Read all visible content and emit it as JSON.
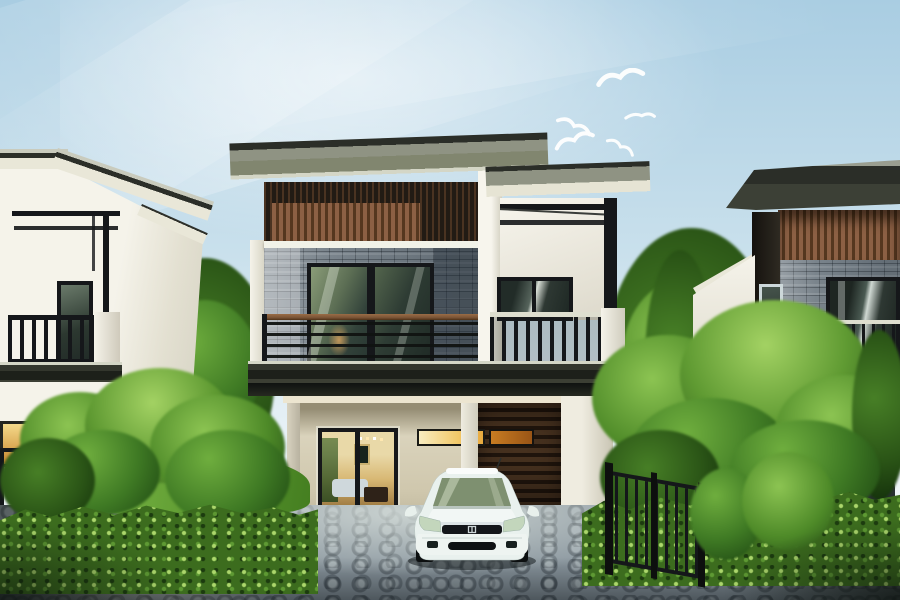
{
  "scene": {
    "type": "architectural-rendering",
    "description": "Modern two-story houses with a carport, a white sedan parked on a cobblestone driveway, trimmed hedges and trees on both sides, pale blue sky with five white birds flying",
    "width_px": 900,
    "height_px": 600
  },
  "sky": {
    "birds_count": 5
  },
  "objects": {
    "car": {
      "type": "white sedan, front view",
      "position": "center foreground"
    },
    "houses": [
      "left neighbor house",
      "main center house",
      "right neighbor house"
    ],
    "driveway": "gray cobblestone pavers",
    "fence": "dark metal picket fence on both sides"
  },
  "colors": {
    "sky_top": "#a9cde2",
    "sky_mid": "#c9e0ec",
    "sky_low": "#edf4f8",
    "roof_edge": "#2b2e28",
    "roof_face": "#81866f",
    "roof_slab_light": "#c9cbbd",
    "fascia_cream": "#e9e7d8",
    "wall_white": "#f5f3ea",
    "wall_shade": "#d5d2c3",
    "interior_cream": "#d9d2bb",
    "wood_dark": "#221b14",
    "wood_slat": "#8c6044",
    "wood_slat_dark": "#55371f",
    "garage_slat": "#46311f",
    "garage_slat_dark": "#20150d",
    "stone_base": "#7a848c",
    "frame_dark": "#15171a",
    "glass_green": "#7e9070",
    "glass_dark": "#2c3833",
    "warm_bright": "#f2c96a",
    "warm_deep": "#b3701f",
    "rail_wood": "#7a5436",
    "rail_light": "#dedecf",
    "hedge_base": "#3c6c1e",
    "grass": "#6fa83a",
    "pave_base": "#8c98a0",
    "pave_light": "#c2ccc8",
    "pave_dark": "#39434a",
    "pave_warm": "#9a8c6e",
    "fence_dark": "#14171a",
    "car_body": "#eef4f1",
    "car_shade": "#c6d4d0",
    "car_glass": "#9db388",
    "suv_dark": "#181c1e",
    "shadow_dark": "#0c1114"
  }
}
